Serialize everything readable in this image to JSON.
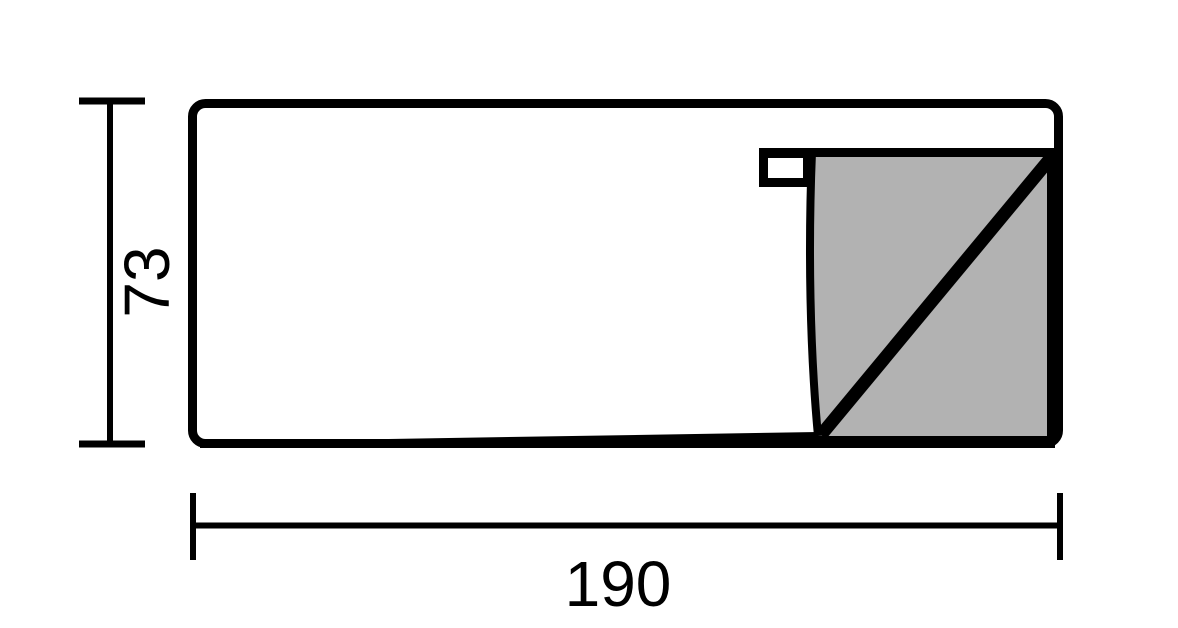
{
  "diagram": {
    "dimensions": {
      "width": {
        "label": "190",
        "value": 190,
        "orientation": "horizontal"
      },
      "height": {
        "label": "73",
        "value": 73,
        "orientation": "vertical"
      }
    },
    "colors": {
      "line": "#000000",
      "section_fill": "#b2b2b2",
      "background": "#ffffff"
    }
  }
}
